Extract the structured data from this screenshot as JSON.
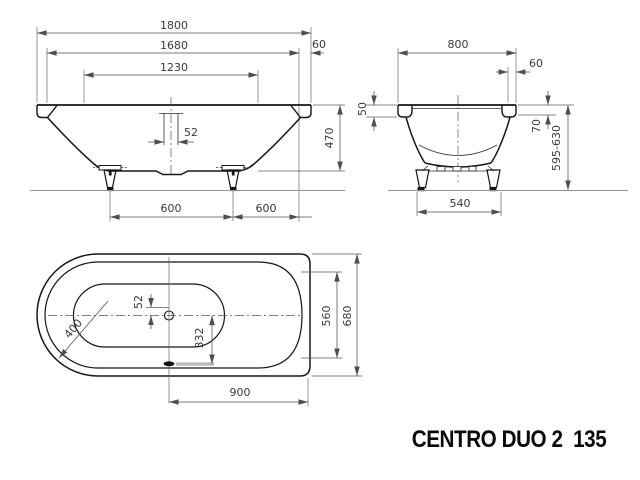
{
  "drawing": {
    "title": "CENTRO DUO 2  135",
    "front_view": {
      "overall_length": "1800",
      "rim_length": "1680",
      "basin_length": "1230",
      "rim_overhang": "60",
      "overflow_width": "52",
      "tub_depth": "470",
      "feet_spacing": "600",
      "feet_to_edge": "600"
    },
    "end_view": {
      "overall_width": "800",
      "rim_overhang": "60",
      "rim_height": "50",
      "overflow_drop": "70",
      "install_height": "595-630",
      "feet_width": "540"
    },
    "plan_view": {
      "overflow_width": "52",
      "drain_offset": "332",
      "corner_radius": "400",
      "basin_width": "560",
      "overall_width": "680",
      "drain_to_end": "900"
    },
    "colors": {
      "outline": "#161616",
      "dimension": "#4f4f4f",
      "floor": "#949494",
      "marking_gray": "#b9b9b9",
      "background": "#ffffff"
    }
  }
}
